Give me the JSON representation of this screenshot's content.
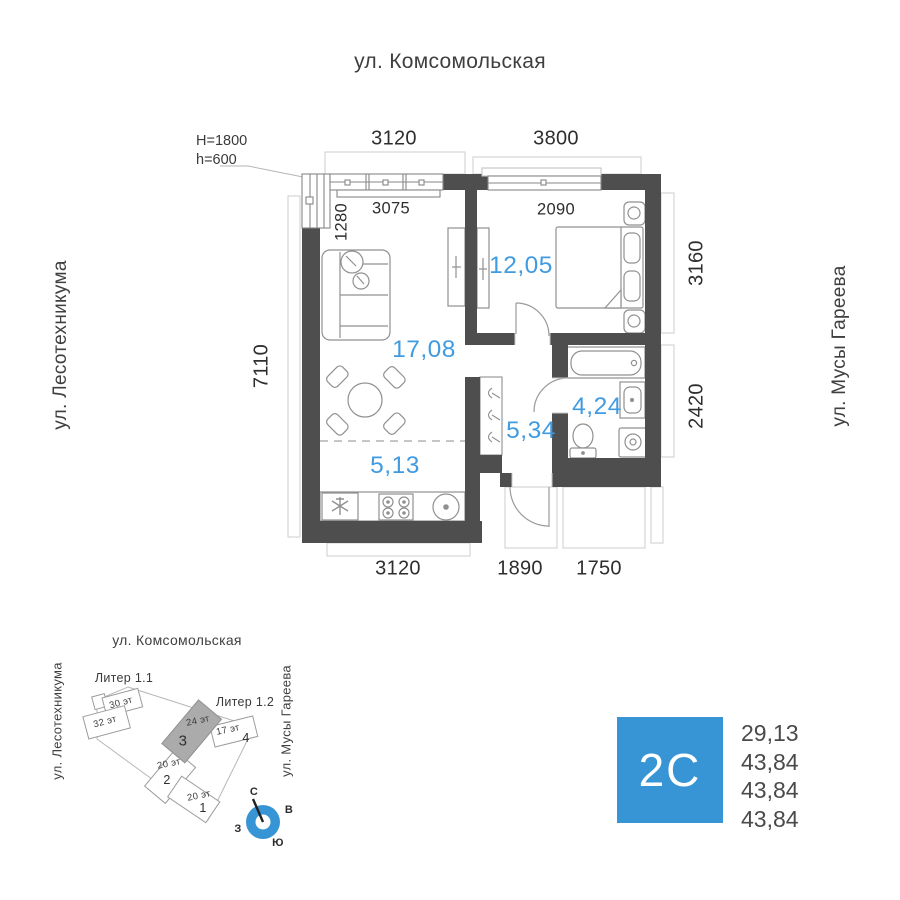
{
  "colors": {
    "accent_blue": "#3795d5",
    "area_label_blue": "#419be0",
    "wall_gray": "#4e4e4e"
  },
  "streets": {
    "top": "ул. Комсомольская",
    "left": "ул. Лесотехникума",
    "right": "ул. Мусы Гареева"
  },
  "plan": {
    "note": {
      "line1": "H=1800",
      "line2": "h=600"
    },
    "dims": {
      "top": [
        "3120",
        "3800"
      ],
      "bottom": [
        "3120",
        "1890",
        "1750"
      ],
      "left": "7110",
      "right": [
        "3160",
        "2420"
      ],
      "inner": [
        "3075",
        "1280",
        "2090"
      ]
    },
    "rooms": [
      {
        "id": "living",
        "area": "17,08"
      },
      {
        "id": "bedroom",
        "area": "12,05"
      },
      {
        "id": "hallway",
        "area": "5,34"
      },
      {
        "id": "bathroom",
        "area": "4,24"
      },
      {
        "id": "kitchen",
        "area": "5,13"
      }
    ]
  },
  "site": {
    "street_top": "ул. Комсомольская",
    "street_left": "ул. Лесотехникума",
    "street_right": "ул. Мусы Гареева",
    "liter1": "Литер 1.1",
    "liter2": "Литер 1.2",
    "buildings": [
      {
        "floors": "30 эт",
        "number": ""
      },
      {
        "floors": "32 эт",
        "number": ""
      },
      {
        "floors": "24 эт",
        "number": "3"
      },
      {
        "floors": "17 эт",
        "number": "4"
      },
      {
        "floors": "20 эт",
        "number": "2"
      },
      {
        "floors": "20 эт",
        "number": "1"
      }
    ],
    "compass": {
      "n": "С",
      "e": "В",
      "w": "З",
      "s": "Ю"
    }
  },
  "info": {
    "type_badge": "2С",
    "values": [
      "29,13",
      "43,84",
      "43,84",
      "43,84"
    ]
  }
}
